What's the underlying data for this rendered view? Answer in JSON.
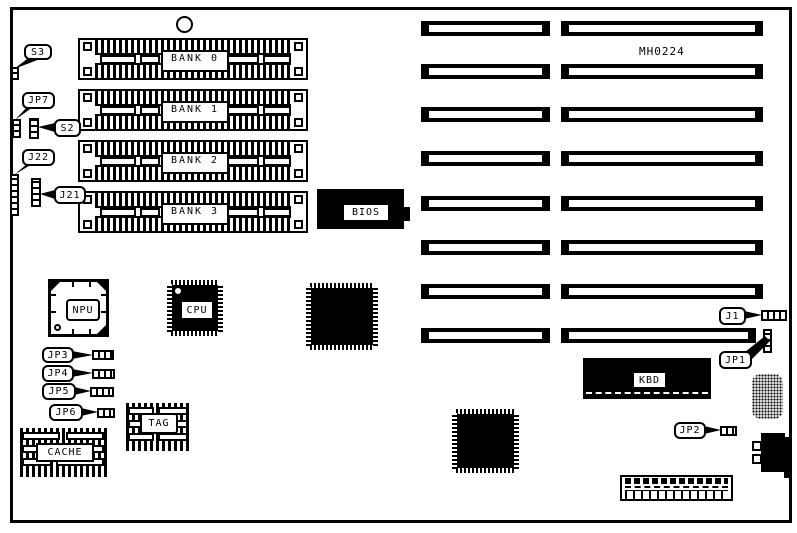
{
  "diagram": {
    "part_number": "MH0224",
    "memory_banks": [
      {
        "label": "BANK 0"
      },
      {
        "label": "BANK 1"
      },
      {
        "label": "BANK 2"
      },
      {
        "label": "BANK 3"
      }
    ],
    "chips": {
      "bios": "BIOS",
      "npu": "NPU",
      "cpu": "CPU",
      "kbd": "KBD",
      "cache": "CACHE",
      "tag": "TAG"
    },
    "jumpers": {
      "s3": "S3",
      "jp7": "JP7",
      "s2": "S2",
      "j22": "J22",
      "j21": "J21",
      "jp3": "JP3",
      "jp4": "JP4",
      "jp5": "JP5",
      "jp6": "JP6",
      "j1": "J1",
      "jp1": "JP1",
      "jp2": "JP2"
    },
    "expansion_slots": {
      "columns": 2,
      "rows_per_column": 8
    },
    "colors": {
      "ink": "#000000",
      "paper": "#ffffff"
    }
  }
}
